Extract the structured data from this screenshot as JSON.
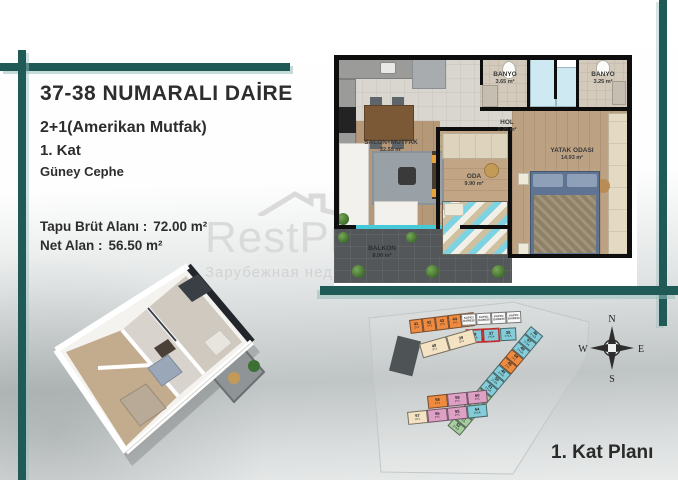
{
  "colors": {
    "accent_teal": "#1f5a57",
    "highlight_red": "#c8221e",
    "unit_orange": "#ef8b41",
    "unit_teal": "#83ccd8",
    "unit_pink": "#dfa0c5",
    "unit_green": "#a6cf9f",
    "unit_cream": "#f3e3c3",
    "unit_white": "#fafafa"
  },
  "info_panel": {
    "title": "37-38 NUMARALI DAİRE",
    "subtitle": "2+1(Amerikan Mutfak)",
    "floor": "1. Kat",
    "facade": "Güney Cephe",
    "gross_area_label": "Tapu Brüt Alanı :",
    "gross_area_value": "72.00 m²",
    "net_area_label": "Net Alan :",
    "net_area_value": "56.50 m²"
  },
  "floor_plan": {
    "rooms": [
      {
        "name": "SALON+MUTFAK",
        "area": "22.55 m²"
      },
      {
        "name": "ODA",
        "area": "9.90 m²"
      },
      {
        "name": "YATAK ODASI",
        "area": "14.93 m²"
      },
      {
        "name": "HOL",
        "area": "2.20 m²"
      },
      {
        "name": "BANYO",
        "area": "3.65 m²"
      },
      {
        "name": "BANYO",
        "area": "3.25 m²"
      },
      {
        "name": "BALKON",
        "area": "8.00 m²"
      }
    ]
  },
  "site_plan": {
    "caption": "1. Kat Planı",
    "compass": {
      "n": "N",
      "e": "E",
      "s": "S",
      "w": "W"
    },
    "orange_row_units": [
      {
        "no": "41",
        "type": "2+1",
        "color": "orange"
      },
      {
        "no": "42",
        "type": "2+1",
        "color": "orange"
      },
      {
        "no": "43",
        "type": "2+1",
        "color": "orange"
      },
      {
        "no": "44",
        "type": "2+1",
        "color": "orange"
      },
      {
        "no": "45",
        "type": "2+1",
        "color": "orange"
      }
    ],
    "kapici_units": [
      {
        "no": "KAPICI",
        "type": "DAİRESİ",
        "color": "white"
      },
      {
        "no": "KAPICI",
        "type": "DAİRESİ",
        "color": "white"
      },
      {
        "no": "KAPICI",
        "type": "DAİRESİ",
        "color": "white"
      },
      {
        "no": "KAPICI",
        "type": "DAİRESİ",
        "color": "white"
      }
    ],
    "entrance_units": [
      {
        "no": "38",
        "type": "2+1A",
        "color": "teal",
        "highlighted": true
      },
      {
        "no": "37",
        "type": "2+1A",
        "color": "teal",
        "highlighted": true
      },
      {
        "no": "36",
        "type": "2+1A",
        "color": "teal"
      }
    ],
    "cream_units": [
      {
        "no": "40",
        "type": "3+1",
        "color": "cream"
      },
      {
        "no": "39",
        "type": "2+1",
        "color": "cream"
      }
    ],
    "diagonal_units": [
      {
        "no": "46",
        "type": "2+1A",
        "color": "teal"
      },
      {
        "no": "47",
        "type": "2+1A",
        "color": "teal"
      },
      {
        "no": "48",
        "type": "2+1A",
        "color": "teal"
      },
      {
        "no": "44",
        "type": "2+1",
        "color": "orange"
      },
      {
        "no": "45",
        "type": "2+1",
        "color": "orange"
      },
      {
        "no": "49",
        "type": "2+1A",
        "color": "teal"
      },
      {
        "no": "50",
        "type": "2+1A",
        "color": "teal"
      },
      {
        "no": "51",
        "type": "2+1A",
        "color": "teal"
      },
      {
        "no": "63",
        "type": "2+1A",
        "color": "green"
      },
      {
        "no": "62",
        "type": "2+1A",
        "color": "green"
      },
      {
        "no": "61",
        "type": "2+1",
        "color": "green"
      },
      {
        "no": "53",
        "type": "2+1A",
        "color": "green"
      },
      {
        "no": "52",
        "type": "2+1A",
        "color": "green"
      }
    ],
    "bottom_row1_units": [
      {
        "no": "58",
        "type": "1+1",
        "color": "orange"
      },
      {
        "no": "59",
        "type": "2+1",
        "color": "pink"
      },
      {
        "no": "60",
        "type": "2+1",
        "color": "pink"
      }
    ],
    "bottom_row2_units": [
      {
        "no": "57",
        "type": "3+1",
        "color": "cream"
      },
      {
        "no": "56",
        "type": "2+1",
        "color": "pink"
      },
      {
        "no": "55",
        "type": "2+1",
        "color": "pink"
      },
      {
        "no": "54",
        "type": "2+1A",
        "color": "teal"
      }
    ]
  },
  "watermark": {
    "brand": "RestPr",
    "tagline": "Зарубежная нед"
  }
}
